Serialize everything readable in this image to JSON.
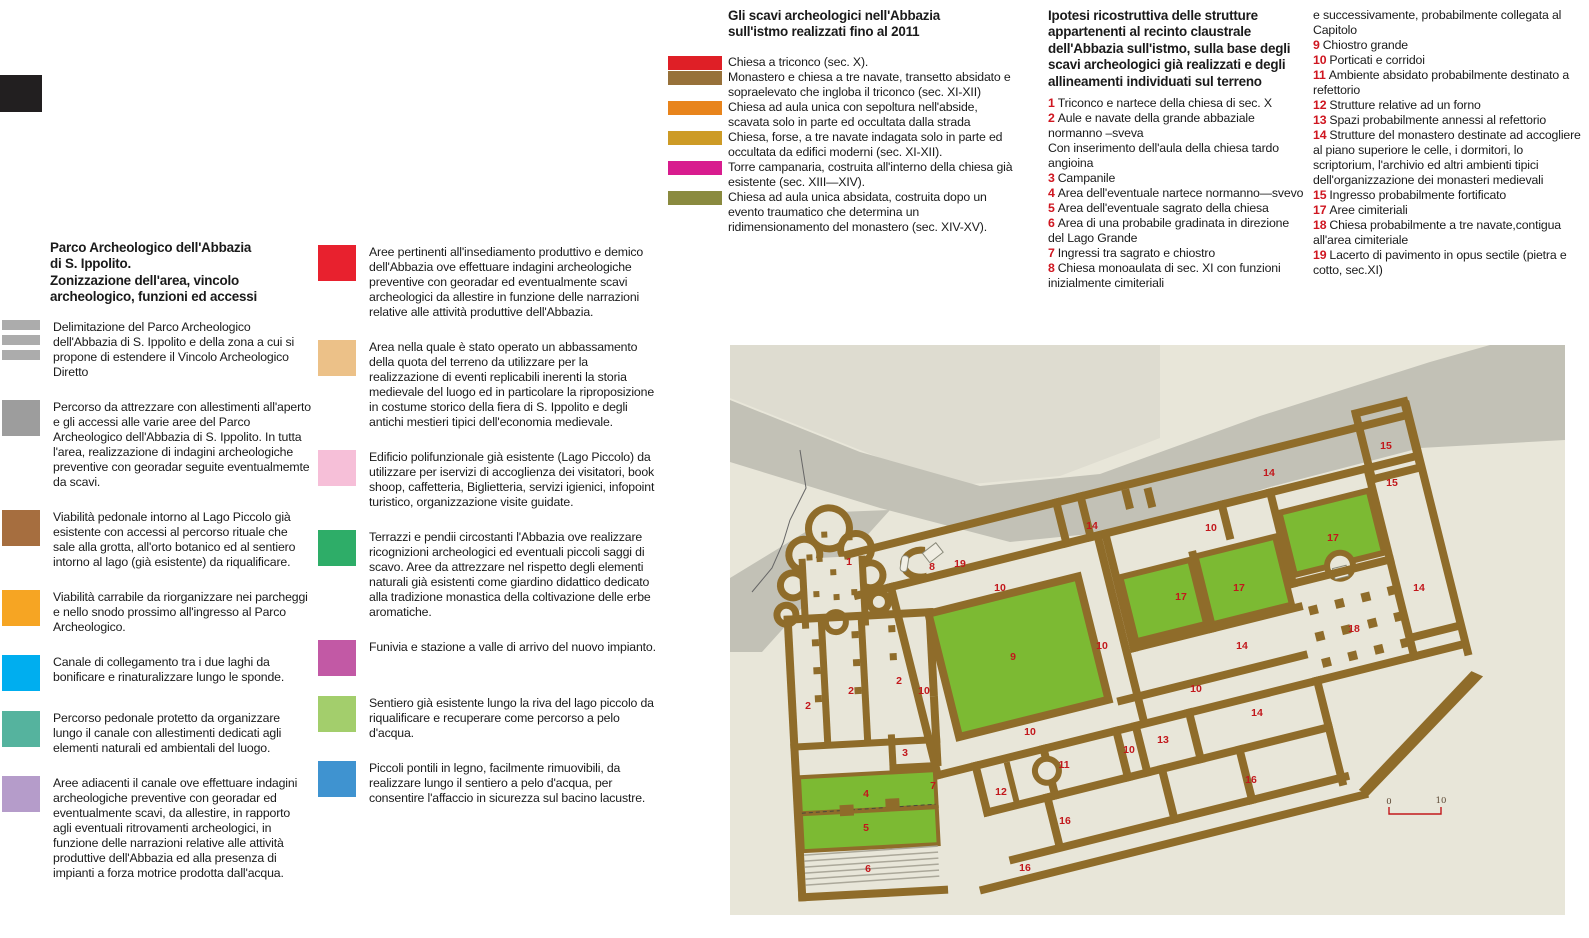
{
  "col1": {
    "title": "Parco Archeologico dell'Abbazia\ndi S. Ippolito.\nZonizzazione dell'area, vincolo\narcheologico, funzioni ed accessi",
    "items": [
      {
        "type": "striped",
        "color": "#acacac",
        "text": "Delimitazione del Parco Archeologico dell'Abbazia di S. Ippolito e della zona a cui si propone di estendere il Vincolo Archeologico Diretto"
      },
      {
        "type": "solid",
        "color": "#9d9d9d",
        "text": "Percorso da attrezzare con allestimenti all'aperto e gli accessi alle  varie aree del Parco Archeologico dell'Abbazia di S. Ippolito. In tutta l'area, realizzazione di indagini archeologiche preventive con georadar seguite eventualmemte da scavi."
      },
      {
        "type": "solid",
        "color": "#a66e3f",
        "text": "Viabilità pedonale intorno al Lago Piccolo già esistente con accessi al percorso rituale che sale alla grotta, all'orto botanico ed al sentiero intorno al lago (già esistente) da riqualificare."
      },
      {
        "type": "solid",
        "color": "#f6a523",
        "text": "Viabilità carrabile da riorganizzare nei parcheggi e nello snodo prossimo all'ingresso al Parco Archeologico."
      },
      {
        "type": "solid",
        "color": "#00aeef",
        "text": "Canale di collegamento tra i due laghi da bonificare e rinaturalizzare lungo le sponde."
      },
      {
        "type": "solid",
        "color": "#55b39e",
        "text": "Percorso pedonale protetto da organizzare lungo il canale con allestimenti dedicati agli elementi naturali ed ambientali del luogo."
      },
      {
        "type": "solid",
        "color": "#b59cca",
        "text": "Aree adiacenti il canale ove effettuare indagini archeologiche preventive con georadar ed eventualmente scavi, da allestire, in rapporto agli eventuali ritrovamenti archeologici, in funzione delle narrazioni relative alle attività produttive dell'Abbazia ed alla presenza di impianti a forza motrice prodotta dall'acqua."
      }
    ]
  },
  "col2": {
    "items": [
      {
        "type": "solid",
        "color": "#e8212e",
        "text": "Aree pertinenti all'insediamento produttivo e demico dell'Abbazia ove effettuare indagini archeologiche preventive con georadar ed eventualmente scavi archeologici da allestire in funzione delle narrazioni relative alle attività produttive dell'Abbazia."
      },
      {
        "type": "solid",
        "color": "#ecc188",
        "text": "Area nella quale è stato operato un abbassamento della quota del terreno da utilizzare per la realizzazione di eventi replicabili inerenti la storia medievale del luogo ed in particolare la riproposizione in costume storico della fiera di S. Ippolito e degli antichi mestieri tipici dell'economia medievale."
      },
      {
        "type": "solid",
        "color": "#f6bfd8",
        "text": "Edificio polifunzionale già  esistente (Lago Piccolo) da utilizzare per iservizi di accoglienza dei visitatori, book shoop, caffetteria, Biglietteria, servizi igienici, infopoint turistico, organizzazione visite guidate."
      },
      {
        "type": "solid",
        "color": "#2ead68",
        "text": "Terrazzi e pendii circostanti l'Abbazia ove realizzare ricognizioni archeologici ed eventuali piccoli saggi di scavo. Aree da attrezzare nel  rispetto degli elementi naturali già esistenti come giardino didattico dedicato alla tradizione monastica della coltivazione delle erbe aromatiche."
      },
      {
        "type": "solid",
        "color": "#c259a5",
        "text": "Funivia e stazione a valle di arrivo del nuovo impianto."
      },
      {
        "type": "solid",
        "color": "#a3ce6c",
        "text": "Sentiero già esistente lungo la riva del lago piccolo da riqualificare e recuperare come percorso a pelo d'acqua."
      },
      {
        "type": "solid",
        "color": "#3f93d0",
        "text": "Piccoli pontili in legno, facilmente rimuovibili, da realizzare lungo il sentiero a pelo d'acqua, per consentire l'affaccio in sicurezza sul bacino lacustre."
      }
    ]
  },
  "col3": {
    "title": "Gli scavi archeologici nell'Abbazia\nsull'istmo realizzati fino al 2011",
    "items": [
      {
        "color": "#df1f26",
        "text": "Chiesa a triconco (sec. X)."
      },
      {
        "color": "#97713a",
        "text": "Monastero e chiesa a tre navate, transetto absidato e sopraelevato che ingloba il triconco (sec. XI-XII)"
      },
      {
        "color": "#e8841c",
        "text": "Chiesa ad aula unica con sepoltura nell'abside, scavata solo in parte ed occultata dalla strada"
      },
      {
        "color": "#cd9b26",
        "text": "Chiesa, forse, a tre navate indagata solo in parte ed occultata da edifici moderni (sec. XI-XII)."
      },
      {
        "color": "#d81c8e",
        "text": "Torre campanaria, costruita all'interno della chiesa già esistente (sec. XIII—XIV)."
      },
      {
        "color": "#8a8a3f",
        "text": "Chiesa ad aula unica absidata, costruita dopo un evento traumatico che determina un ridimensionamento del monastero (sec. XIV-XV)."
      }
    ]
  },
  "col4": {
    "title": "Ipotesi ricostruttiva delle strutture\nappartenenti al recinto claustrale\ndell'Abbazia sull'istmo, sulla base degli\nscavi archeologici già realizzati e degli\nallineamenti individuati sul terreno",
    "items": [
      {
        "n": "1",
        "text": "Triconco e nartece della chiesa di sec. X"
      },
      {
        "n": "2",
        "text": "Aule e navate della grande abbaziale normanno –sveva"
      },
      {
        "n": "",
        "text": "Con inserimento dell'aula della chiesa tardo angioina"
      },
      {
        "n": "3",
        "text": "Campanile"
      },
      {
        "n": "4",
        "text": "Area dell'eventuale nartece normanno—svevo"
      },
      {
        "n": "5",
        "text": "Area dell'eventuale sagrato della chiesa"
      },
      {
        "n": "6",
        "text": "Area di una probabile gradinata in direzione del Lago Grande"
      },
      {
        "n": "7",
        "text": "Ingressi tra sagrato e chiostro"
      },
      {
        "n": "8",
        "text": "Chiesa monoaulata di sec. XI con funzioni inizialmente cimiteriali"
      }
    ]
  },
  "col5": {
    "items": [
      {
        "n": "",
        "text": "e successivamente, probabilmente collegata al Capitolo"
      },
      {
        "n": "9",
        "text": "Chiostro grande"
      },
      {
        "n": "10",
        "text": "Porticati e corridoi"
      },
      {
        "n": "11",
        "text": "Ambiente absidato probabilmente destinato a refettorio"
      },
      {
        "n": "12",
        "text": "Strutture relative ad un forno"
      },
      {
        "n": "13",
        "text": "Spazi probabilmente annessi al refettorio"
      },
      {
        "n": "14",
        "text": "Strutture del monastero destinate ad accogliere al piano superiore le celle, i dormitori, lo scriptorium, l'archivio ed altri ambienti tipici dell'organizzazione dei monasteri medievali"
      },
      {
        "n": "15",
        "text": "Ingresso probabilmente fortificato"
      },
      {
        "n": "17",
        "text": "Aree cimiteriali"
      },
      {
        "n": "18",
        "text": "Chiesa probabilmente a tre navate,contigua all'area cimiteriale"
      },
      {
        "n": "19",
        "text": "Lacerto di pavimento in opus sectile (pietra e cotto, sec.XI)"
      }
    ]
  },
  "map": {
    "colors": {
      "bg": "#e8e6d9",
      "zone": "#dedcd0",
      "road": "#c2c1b6",
      "wall": "#8f6c2a",
      "green": "#7cba33",
      "label": "#c2181c",
      "scale_line": "#c2181c",
      "scale_text": "#5a4632",
      "stairs": "#aba89a",
      "boundary": "#666666"
    },
    "labels": [
      {
        "n": "1",
        "x": 849,
        "y": 561
      },
      {
        "n": "8",
        "x": 932,
        "y": 566
      },
      {
        "n": "19",
        "x": 960,
        "y": 563
      },
      {
        "n": "14",
        "x": 1092,
        "y": 525
      },
      {
        "n": "14",
        "x": 1269,
        "y": 472
      },
      {
        "n": "15",
        "x": 1386,
        "y": 445
      },
      {
        "n": "15",
        "x": 1392,
        "y": 482
      },
      {
        "n": "10",
        "x": 1000,
        "y": 587
      },
      {
        "n": "10",
        "x": 1211,
        "y": 527
      },
      {
        "n": "17",
        "x": 1181,
        "y": 596
      },
      {
        "n": "17",
        "x": 1239,
        "y": 587
      },
      {
        "n": "17",
        "x": 1333,
        "y": 537
      },
      {
        "n": "14",
        "x": 1419,
        "y": 587
      },
      {
        "n": "18",
        "x": 1354,
        "y": 628
      },
      {
        "n": "14",
        "x": 1242,
        "y": 645
      },
      {
        "n": "9",
        "x": 1013,
        "y": 656
      },
      {
        "n": "2",
        "x": 808,
        "y": 705
      },
      {
        "n": "2",
        "x": 851,
        "y": 690
      },
      {
        "n": "2",
        "x": 899,
        "y": 680
      },
      {
        "n": "10",
        "x": 924,
        "y": 690
      },
      {
        "n": "10",
        "x": 1102,
        "y": 645
      },
      {
        "n": "3",
        "x": 905,
        "y": 752
      },
      {
        "n": "7",
        "x": 933,
        "y": 785
      },
      {
        "n": "4",
        "x": 866,
        "y": 793
      },
      {
        "n": "5",
        "x": 866,
        "y": 827
      },
      {
        "n": "6",
        "x": 868,
        "y": 868
      },
      {
        "n": "10",
        "x": 1030,
        "y": 731
      },
      {
        "n": "11",
        "x": 1064,
        "y": 764
      },
      {
        "n": "12",
        "x": 1001,
        "y": 791
      },
      {
        "n": "13",
        "x": 1163,
        "y": 739
      },
      {
        "n": "10",
        "x": 1129,
        "y": 749
      },
      {
        "n": "10",
        "x": 1196,
        "y": 688
      },
      {
        "n": "14",
        "x": 1257,
        "y": 712
      },
      {
        "n": "16",
        "x": 1065,
        "y": 820
      },
      {
        "n": "16",
        "x": 1025,
        "y": 867
      },
      {
        "n": "16",
        "x": 1251,
        "y": 779
      }
    ],
    "scale": {
      "start": "0",
      "end": "10"
    }
  }
}
